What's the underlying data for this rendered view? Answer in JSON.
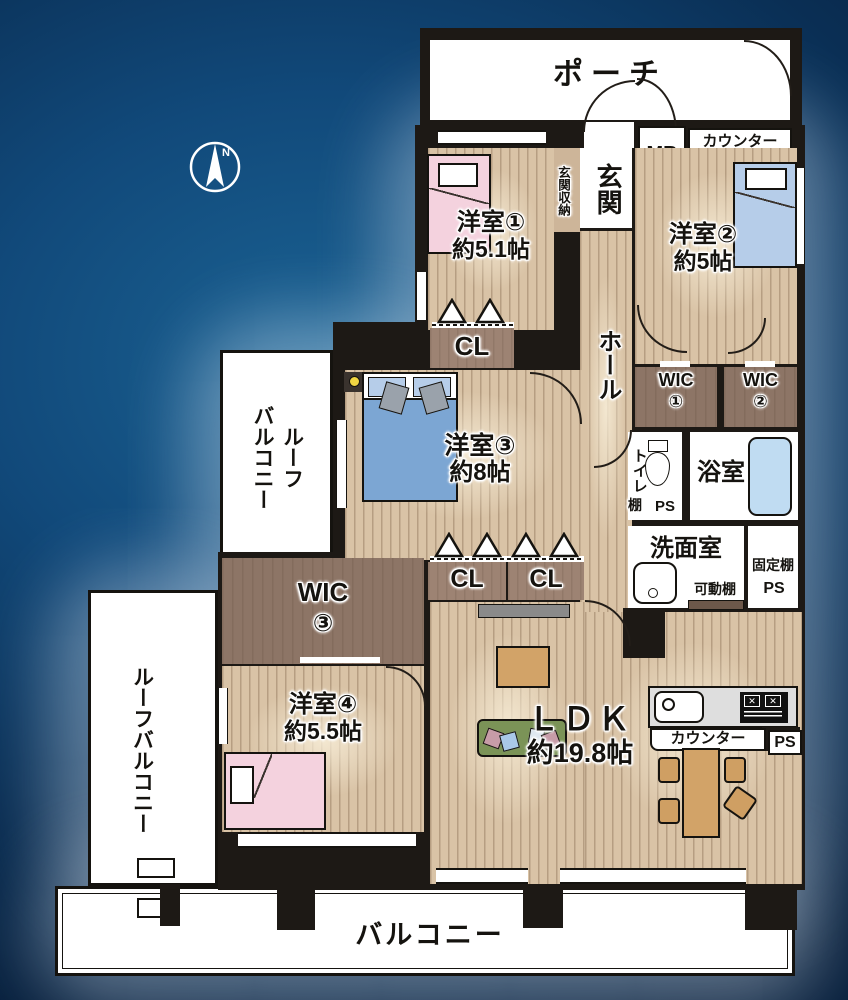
{
  "plan": {
    "compass_label": "N",
    "porch": "ポーチ",
    "mb": "MB",
    "counter_upper": "カウンター",
    "entrance": "玄関",
    "entrance_storage": "玄関収納",
    "hall": "ホール",
    "room1_name": "洋室①",
    "room1_size": "約5.1帖",
    "room2_name": "洋室②",
    "room2_size": "約5帖",
    "room3_name": "洋室③",
    "room3_size": "約8帖",
    "room4_name": "洋室④",
    "room4_size": "約5.5帖",
    "ldk_name": "ＬＤＫ",
    "ldk_size": "約19.8帖",
    "cl_room1": "CL",
    "cl_room3_a": "CL",
    "cl_room3_b": "CL",
    "wic1_name": "WIC",
    "wic1_num": "①",
    "wic2_name": "WIC",
    "wic2_num": "②",
    "wic3_name": "WIC",
    "wic3_num": "③",
    "toilet": "トイレ",
    "shelf": "棚",
    "ps_toilet": "PS",
    "bath": "浴室",
    "washroom": "洗面室",
    "movable_shelf": "可動棚",
    "fixed_shelf": "固定棚",
    "ps_fixed": "PS",
    "kitchen_counter": "カウンター",
    "ps_kitchen": "PS",
    "roof_balcony_upper_line1": "ルーフ",
    "roof_balcony_upper_line2": "バルコニー",
    "roof_balcony_lower": "ルーフバルコニー",
    "balcony": "バルコニー"
  },
  "colors": {
    "wall": "#1d1915",
    "floor": "#d9c3a6",
    "wic": "#8d7566",
    "cl": "#9d8373",
    "bed_pink": "#f4d2de",
    "bed_blue_light": "#b6cde9",
    "bed_blue": "#7ca6d3",
    "tub": "#c0dcf2",
    "sofa": "#7b9357",
    "wood_furniture": "#d2a368",
    "kitchen": "#dedede",
    "bg_center": "#1b6394",
    "bg_edge": "#071f3c"
  }
}
